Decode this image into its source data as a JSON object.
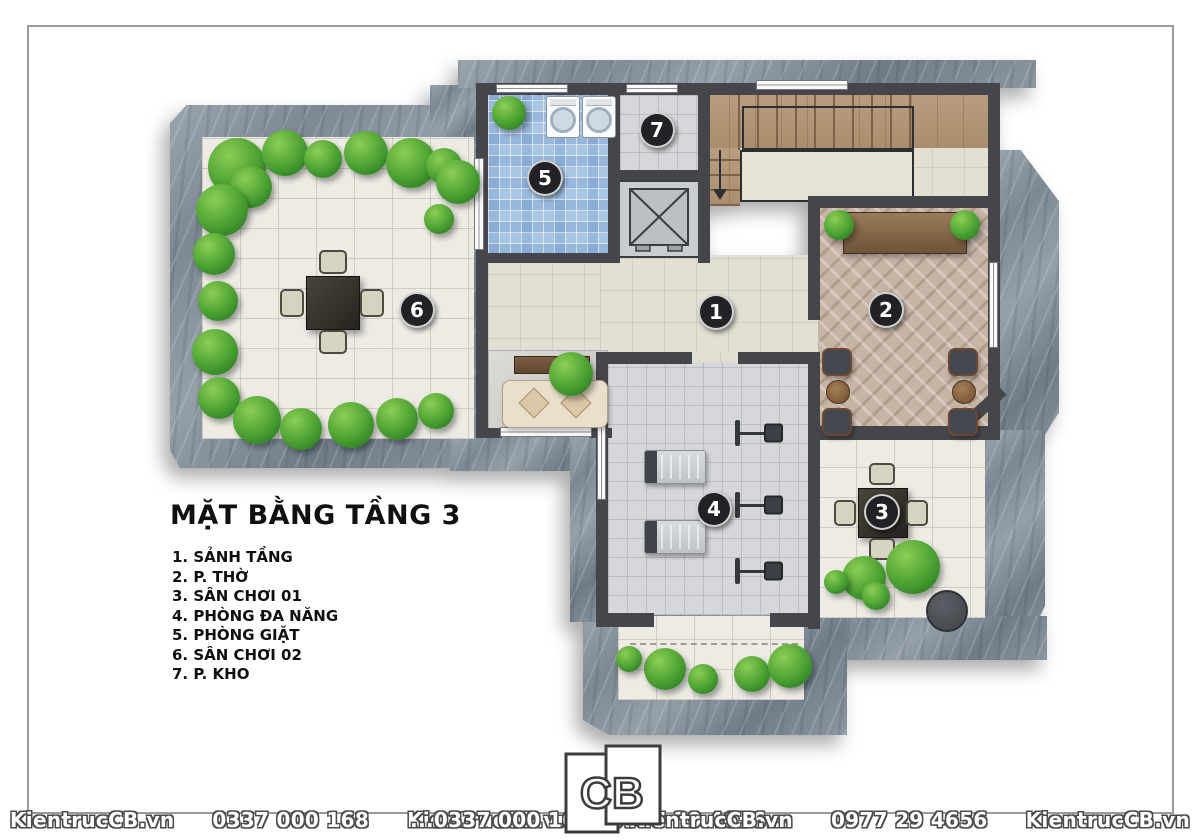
{
  "title": "MẶT BẰNG TẦNG 3",
  "legend": {
    "items": [
      "1. SẢNH TẦNG",
      "2. P. THỜ",
      "3. SÂN CHƠI 01",
      "4. PHÒNG ĐA NĂNG",
      "5. PHÒNG GIẶT",
      "6. SÂN CHƠI 02",
      "7. P. KHO"
    ]
  },
  "rooms": [
    {
      "number": "1",
      "name": "SẢNH TẦNG"
    },
    {
      "number": "2",
      "name": "P. THỜ"
    },
    {
      "number": "3",
      "name": "SÂN CHƠI 01"
    },
    {
      "number": "4",
      "name": "PHÒNG ĐA NĂNG"
    },
    {
      "number": "5",
      "name": "PHÒNG GIẶT"
    },
    {
      "number": "6",
      "name": "SÂN CHƠI 02"
    },
    {
      "number": "7",
      "name": "P. KHO"
    }
  ],
  "watermark": {
    "left": [
      "KientrucCB.vn",
      "0337 000 168",
      "KientrucCB.vn",
      "0977 29 4656..."
    ],
    "right": [
      "...0337 000 168",
      "KientrucCB.vn",
      "0977 29 4656",
      "KientrucCB.vn"
    ]
  },
  "logo": {
    "c": "C",
    "b": "B"
  },
  "colors": {
    "stone": "#8594a0",
    "wall": "#44464b",
    "floor_cream": "#e3e0d3",
    "tile_blue": "#a9c7e5",
    "wood_stairs": "#b99b7d",
    "herringbone": "#c6b4a5",
    "greenery": "#4aa032",
    "badge": "#222226"
  }
}
